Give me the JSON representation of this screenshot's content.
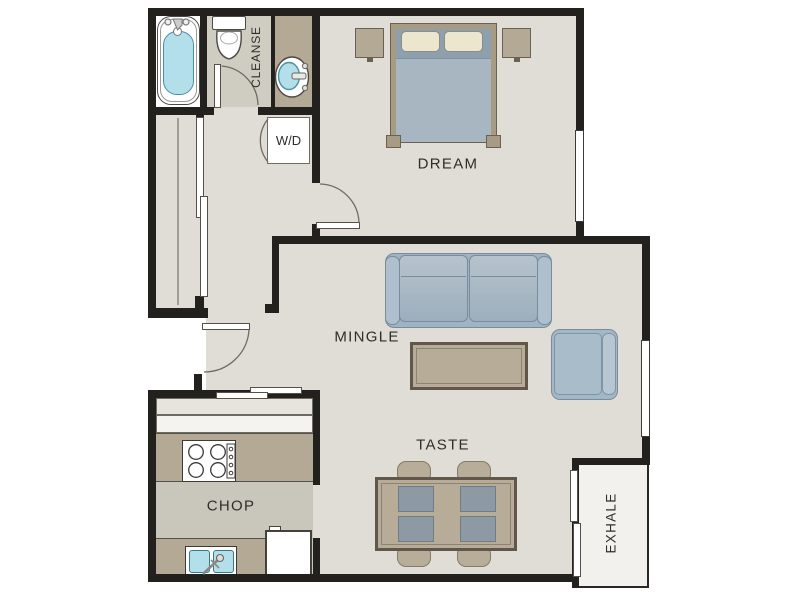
{
  "page": {
    "title": "One-bedroom apartment floor plan"
  },
  "rooms": {
    "bathroom": {
      "label": "CLEANSE"
    },
    "laundry": {
      "label": "W/D"
    },
    "bedroom": {
      "label": "DREAM"
    },
    "living": {
      "label": "MINGLE"
    },
    "dining": {
      "label": "TASTE"
    },
    "kitchen": {
      "label": "CHOP"
    },
    "balcony": {
      "label": "EXHALE"
    }
  },
  "colors": {
    "wall": "#23211d",
    "floor-light": "#dfddd5",
    "floor-bath": "#cfccc2",
    "floor-kitchen": "#c9c6bb",
    "counter-tan": "#b3a994",
    "balcony-floor": "#f2f1ee",
    "water-blue": "#b3dfeb",
    "water-border": "#4b8fa3",
    "sofa-blue": "#a9bcc9",
    "sofa-border": "#7a8c9c",
    "wood-tan": "#b7ac97",
    "wood-dark": "#60564a",
    "pillow-cream": "#ece6cf",
    "placemat-gray": "#8d9aa4",
    "chair-tan": "#b7ad99",
    "chair-border": "#847b69",
    "label-text": "#2f2d29",
    "line-gray": "#6f6b62"
  }
}
